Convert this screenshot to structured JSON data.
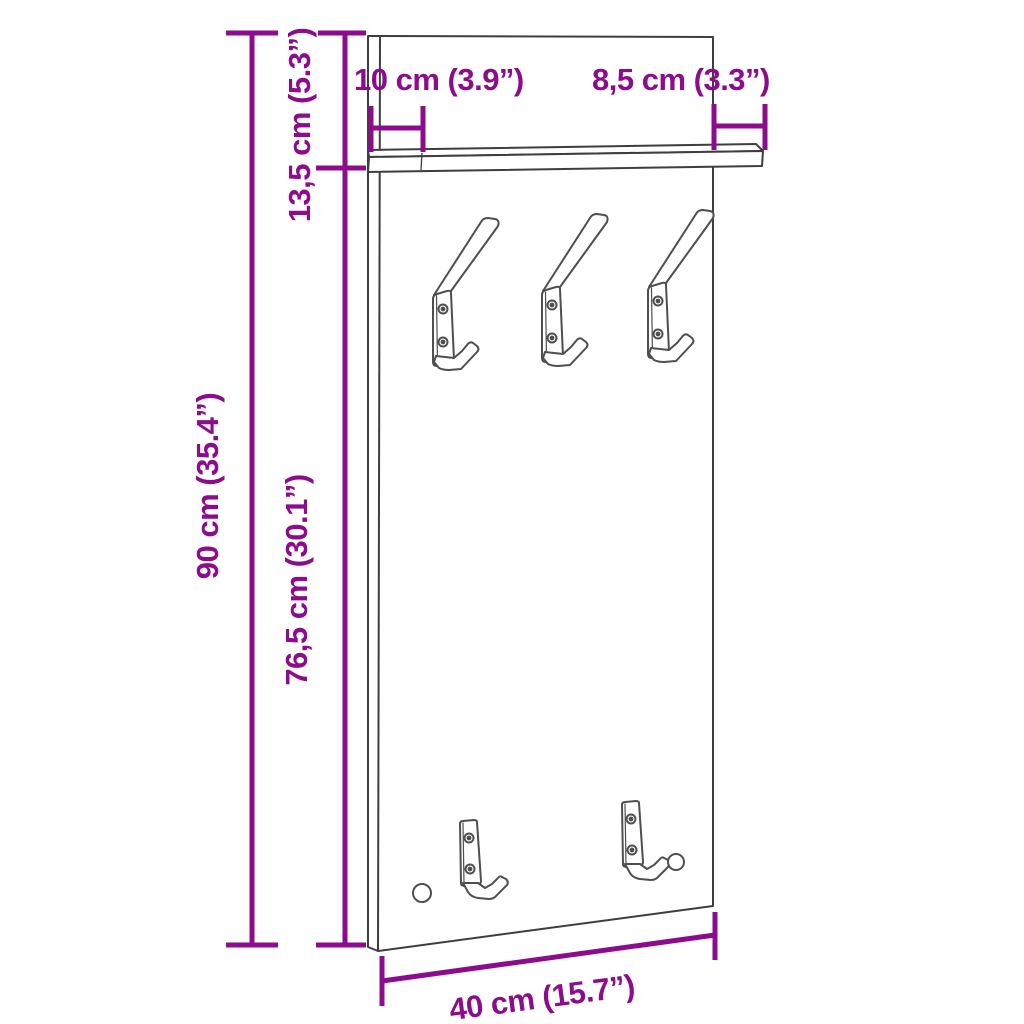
{
  "diagram": {
    "accent_color": "#8D0C8D",
    "line_color": "#3e3e3e",
    "labels": {
      "shelf_depth": "10 cm (3.9”)",
      "shelf_overhang": "8,5 cm (3.3”)",
      "upper_section_height": "13,5 cm (5.3”)",
      "total_height": "90 cm (35.4”)",
      "lower_section_height": "76,5 cm (30.1”)",
      "total_width": "40 cm (15.7”)"
    }
  }
}
